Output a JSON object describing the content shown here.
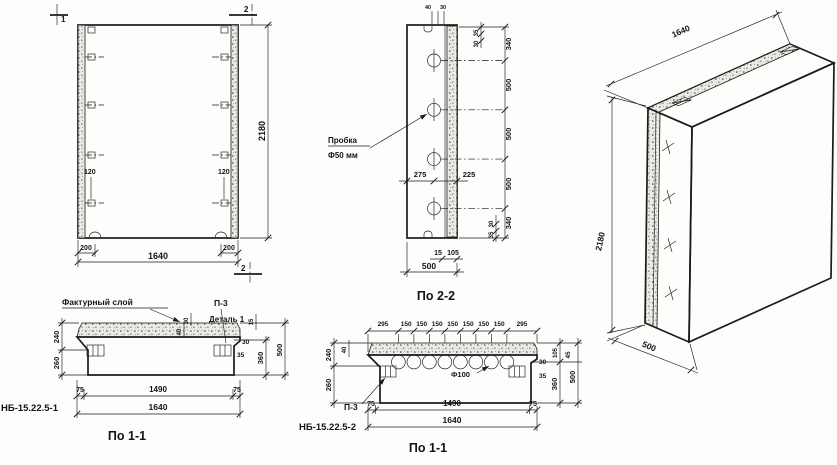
{
  "front_view": {
    "section_marker_1": "1",
    "section_marker_2_top": "2",
    "section_marker_2_bottom": "2",
    "anchor_offset_left": "120",
    "anchor_offset_right": "120",
    "edge_dim_left": "200",
    "edge_dim_right": "200",
    "width_dim": "1640",
    "height_dim": "2180"
  },
  "section_2_2": {
    "caption": "По 2-2",
    "plug_label_line1": "Пробка",
    "plug_label_line2": "Ф50 мм",
    "top_tiny_dims": [
      "40",
      "30"
    ],
    "top_side_dims": [
      "35",
      "30"
    ],
    "height_dims": [
      "340",
      "500",
      "500",
      "500",
      "340"
    ],
    "plug_offset_left": "275",
    "plug_offset_right": "225",
    "bottom_side_dims": [
      "30",
      "35"
    ],
    "bottom_small_dims": [
      "15",
      "105"
    ],
    "thickness_dim": "500"
  },
  "isometric_view": {
    "length_dim": "1640",
    "height_dim": "2180",
    "thickness_dim": "500"
  },
  "section_1_1_left": {
    "caption": "По 1-1",
    "part_mark": "НБ-15.22.5-1",
    "facing_layer_label": "Фактурный слой",
    "channel_label": "П-3",
    "detail_label": "Деталь 1",
    "thickness_dims": [
      "240",
      "260"
    ],
    "facing_dims": [
      "30",
      "40"
    ],
    "rib_dims": [
      "30",
      "35"
    ],
    "right_dims": [
      "15",
      "360",
      "500"
    ],
    "bottom_dims": [
      "75",
      "1490",
      "75"
    ],
    "width_dim": "1640"
  },
  "section_1_1_right": {
    "caption": "По 1-1",
    "part_mark": "НБ-15.22.5-2",
    "channel_label": "П-3",
    "hole_label": "Ф100",
    "top_dims": [
      "295",
      "150",
      "150",
      "150",
      "150",
      "150",
      "150",
      "150",
      "295"
    ],
    "thickness_dims": [
      "240",
      "260"
    ],
    "facing_dim": "40",
    "rib_dims": [
      "30",
      "35"
    ],
    "right_dims": [
      "105",
      "45",
      "360",
      "500"
    ],
    "bottom_dims": [
      "75",
      "1490",
      "75"
    ],
    "width_dim": "1640"
  }
}
